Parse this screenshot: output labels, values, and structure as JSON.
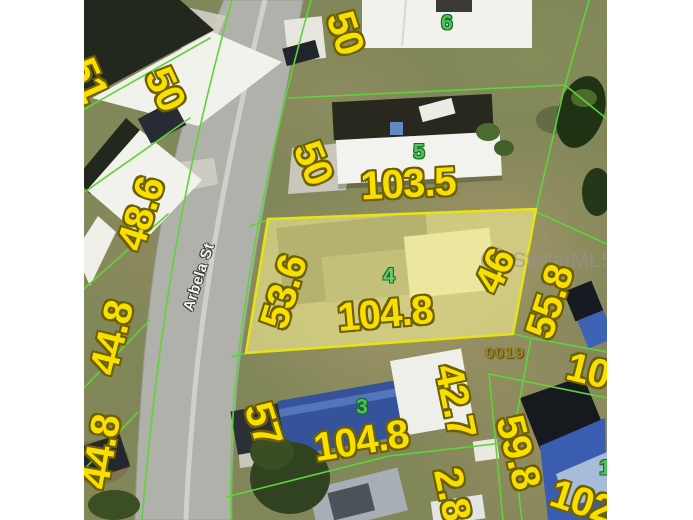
{
  "watermark_text": "StellarMLS",
  "street_label": "Arbela St",
  "parcel_id_label": "0019",
  "colors": {
    "dimension_text": "#F8DF00",
    "dimension_outline": "#6E6000",
    "parcel_line": "#5FD33A",
    "lot_number_text": "#4FC05C",
    "subject_parcel_fill": "#F7F294",
    "subject_parcel_border": "#E8E312",
    "road": "#B1B1AC",
    "grass": "#82875A",
    "watermark_gray": "#949494"
  },
  "lot_numbers": [
    {
      "id": "lot-6",
      "label": "6"
    },
    {
      "id": "lot-5",
      "label": "5"
    },
    {
      "id": "lot-4",
      "label": "4"
    },
    {
      "id": "lot-3",
      "label": "3"
    },
    {
      "id": "lot-1",
      "label": "1"
    }
  ],
  "dimension_labels": [
    {
      "id": "dim-51-top-left",
      "text": "51"
    },
    {
      "id": "dim-50-west",
      "text": "50"
    },
    {
      "id": "dim-50-east-top",
      "text": "50"
    },
    {
      "id": "dim-50-east-mid",
      "text": "50"
    },
    {
      "id": "dim-48-6",
      "text": "48.6"
    },
    {
      "id": "dim-44-8-upper",
      "text": "44.8"
    },
    {
      "id": "dim-44-8-lower",
      "text": "44.8"
    },
    {
      "id": "dim-53-6",
      "text": "53.6"
    },
    {
      "id": "dim-104-8-lot4",
      "text": "104.8"
    },
    {
      "id": "dim-46",
      "text": "46"
    },
    {
      "id": "dim-103-5",
      "text": "103.5"
    },
    {
      "id": "dim-57",
      "text": "57"
    },
    {
      "id": "dim-104-8-lot3",
      "text": "104.8"
    },
    {
      "id": "dim-42-7",
      "text": "42.7"
    },
    {
      "id": "dim-2-8",
      "text": "2.8"
    },
    {
      "id": "dim-55-8",
      "text": "55.8"
    },
    {
      "id": "dim-59-8",
      "text": "59.8"
    },
    {
      "id": "dim-10-cut",
      "text": "10"
    },
    {
      "id": "dim-102-cut",
      "text": "102"
    }
  ]
}
